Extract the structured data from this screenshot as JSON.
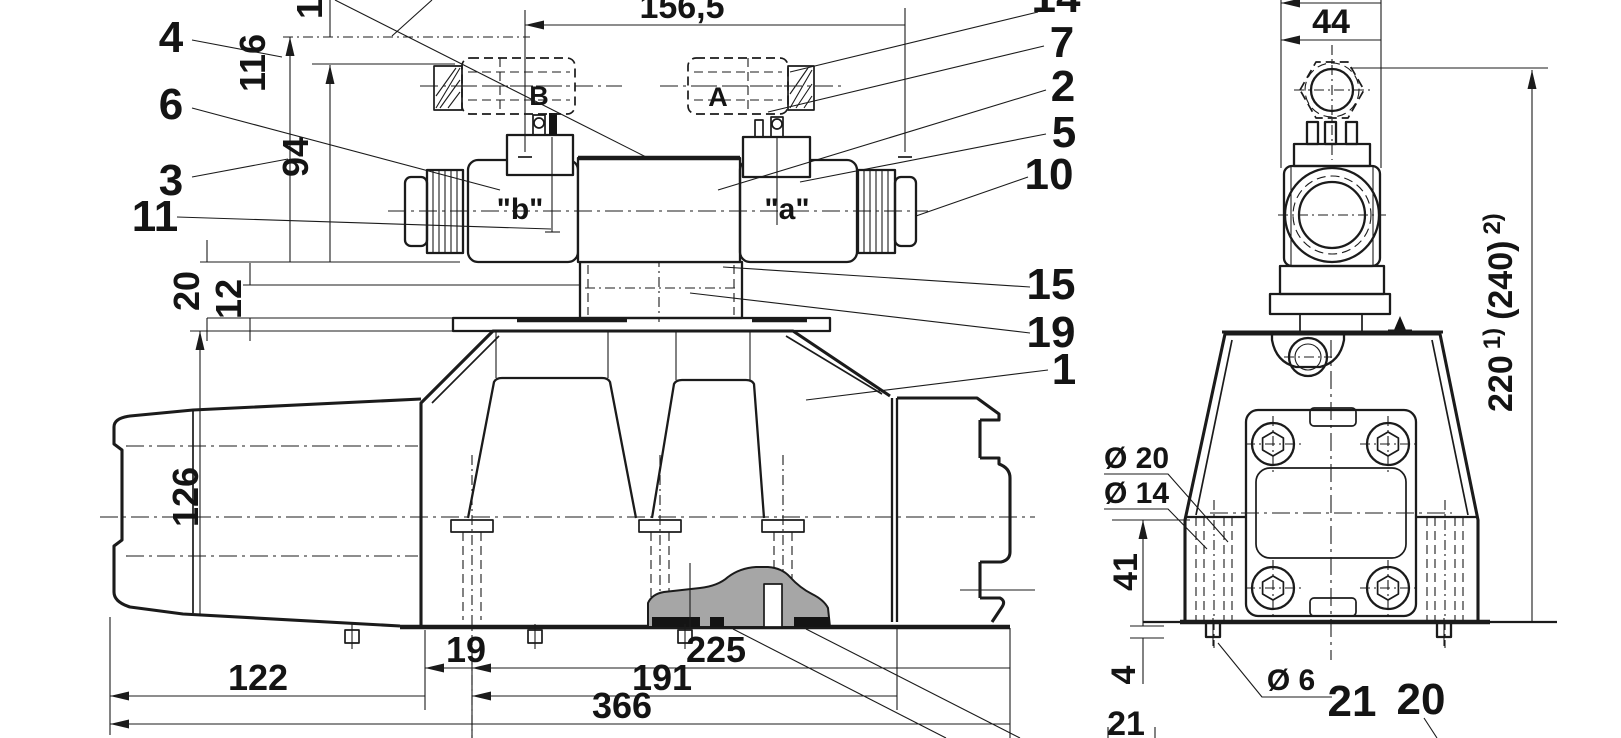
{
  "drawing": {
    "type": "technical-dimension-drawing",
    "line_color": "#1b1b1b",
    "background": "#ffffff",
    "cam_fill": "#a6a6a6"
  },
  "front_view": {
    "dims": {
      "span": "156,5",
      "h116": "116",
      "h94": "94",
      "o20": "20",
      "o12": "12",
      "h126": "126",
      "b122": "122",
      "b19": "19",
      "b225": "225",
      "b191": "191",
      "b366": "366"
    },
    "labels": {
      "sol_b": "\"b\"",
      "sol_a": "\"a\"",
      "port_b": "B",
      "port_a": "A"
    },
    "callouts": {
      "c1_top": "1",
      "c4": "4",
      "c6": "6",
      "c3": "3",
      "c11": "11",
      "c14": "14",
      "c7": "7",
      "c2": "2",
      "c5": "5",
      "c10": "10",
      "c15": "15",
      "c19": "19",
      "c1": "1"
    }
  },
  "side_view": {
    "dims": {
      "w44": "44",
      "h220": "220",
      "sup1": "1)",
      "alt240": "(240)",
      "sup2": "2)",
      "dia20": "Ø 20",
      "dia14": "Ø 14",
      "h41": "41",
      "h4": "4",
      "dia6": "Ø 6",
      "off21": "21"
    },
    "callouts": {
      "c21": "21",
      "c20": "20"
    }
  }
}
